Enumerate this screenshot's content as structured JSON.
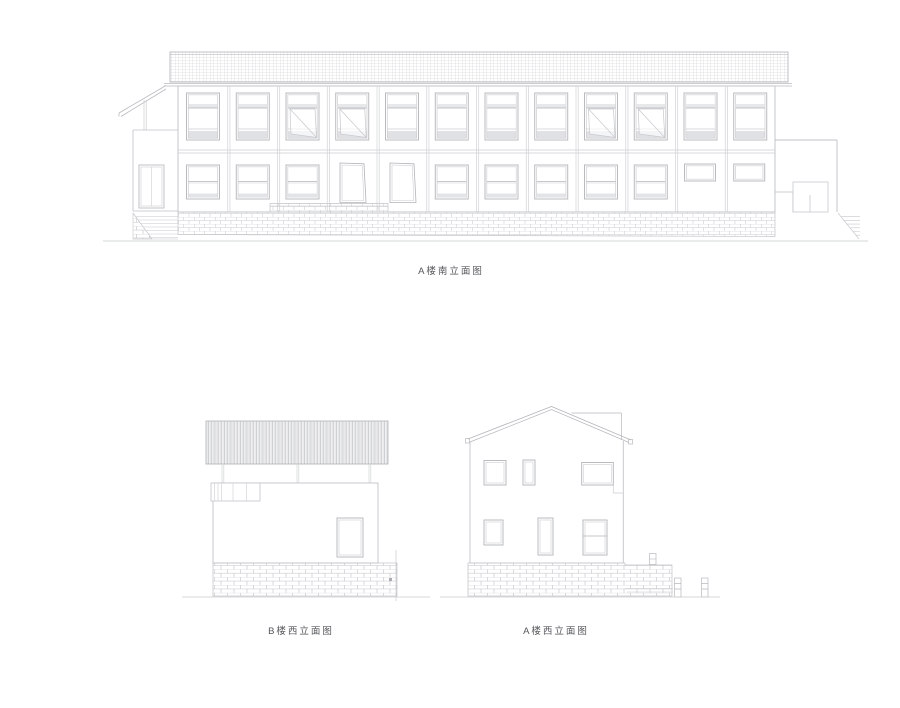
{
  "sheet": {
    "background_color": "#ffffff",
    "line_color_light": "#c6c8cc",
    "line_color_mid": "#b0b2b6",
    "shading_color": "#e2e3e6",
    "label_color": "#54575b"
  },
  "elevations": {
    "a_south": {
      "label": "A楼南立面图",
      "floors": 2,
      "upper_window_count": 12
    },
    "b_west": {
      "label": "B楼西立面图"
    },
    "a_west": {
      "label": "A楼西立面图",
      "floors": 2
    }
  }
}
